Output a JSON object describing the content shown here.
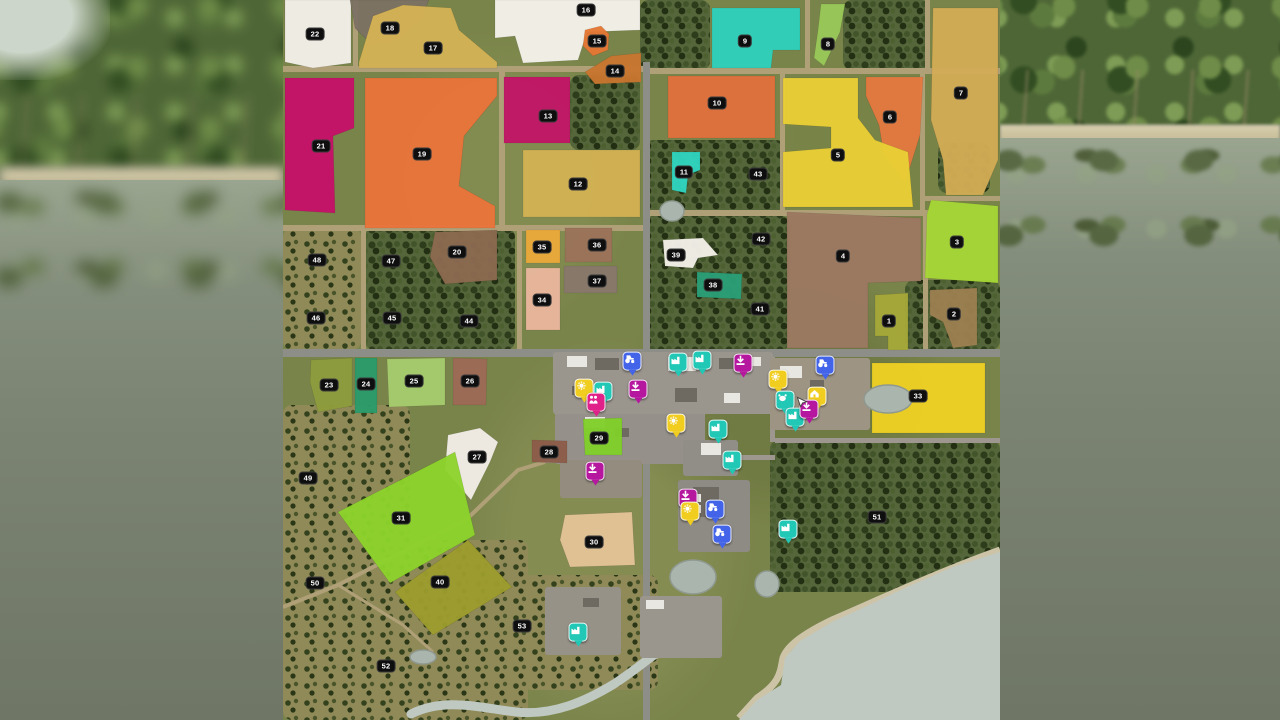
{
  "meta": {
    "view": "farming-map-overview",
    "screen_size": [
      1280,
      720
    ],
    "map_rect": [
      283,
      0,
      717,
      720
    ]
  },
  "palette": {
    "grass": "#79844a",
    "forest_dense": "#55663b",
    "forest_sparse": "#8f8a58",
    "dirt_road": "#b0a078",
    "asphalt_road": "#8e8e88",
    "street": "#9d978f",
    "water": "#bfc9c2",
    "pond": "#aab5ad",
    "sand": "#cdc4a8",
    "label_bg": "#0e0e0e",
    "label_fg": "#ffffff"
  },
  "icon_styles": {
    "sell": {
      "color": "#b5179e",
      "glyph": "download-arrow-icon"
    },
    "production": {
      "color": "#22c8b6",
      "glyph": "factory-icon"
    },
    "store": {
      "color": "#f0cd1f",
      "glyph": "gear-icon"
    },
    "farmhouse": {
      "color": "#f0cd1f",
      "glyph": "house-icon"
    },
    "dealer": {
      "color": "#4364e8",
      "glyph": "tractor-icon"
    },
    "family": {
      "color": "#e0218a",
      "glyph": "people-icon"
    },
    "animal": {
      "color": "#22c8b6",
      "glyph": "cow-icon"
    }
  },
  "fields": [
    {
      "id": "22",
      "color": "#f3efe9",
      "points": "2,0 68,0 68,63 30,68 2,62",
      "label": [
        32,
        34
      ]
    },
    {
      "id": "18",
      "color": "#7c7163",
      "points": "67,0 146,0 138,20 112,42 88,44 72,28",
      "label": [
        107,
        28
      ]
    },
    {
      "id": "17",
      "color": "#d3b254",
      "points": "76,62 90,16 120,5 168,8 176,30 214,62 214,68 76,68",
      "label": [
        150,
        48
      ]
    },
    {
      "id": "16",
      "color": "#f4f1ea",
      "points": "212,0 357,0 357,30 304,32 295,60 240,63 232,36 212,38",
      "label": [
        303,
        10
      ]
    },
    {
      "id": "15",
      "color": "#e47733",
      "points": "302,30 318,26 326,34 325,50 310,56 300,46",
      "label": [
        314,
        41
      ]
    },
    {
      "id": "14",
      "color": "#c8762f",
      "points": "302,72 328,56 358,53 358,82 312,84",
      "label": [
        332,
        71
      ]
    },
    {
      "id": "21",
      "color": "#c61168",
      "points": "2,78 71,78 71,128 50,136 52,213 2,210",
      "label": [
        38,
        146
      ]
    },
    {
      "id": "19",
      "color": "#e9743a",
      "points": "82,78 214,78 214,96 181,136 176,186 212,206 212,228 82,228",
      "label": [
        139,
        154
      ]
    },
    {
      "id": "13",
      "color": "#c21567",
      "points": "221,77 287,77 287,143 221,143",
      "label": [
        265,
        116
      ]
    },
    {
      "id": "12",
      "color": "#d2b152",
      "points": "240,150 357,150 357,217 240,217",
      "label": [
        295,
        184
      ]
    },
    {
      "id": "9",
      "color": "#2fd0ba",
      "points": "429,8 517,8 517,50 490,50 488,68 429,68",
      "label": [
        462,
        41
      ]
    },
    {
      "id": "8",
      "color": "#98c858",
      "points": "538,4 562,4 557,32 541,66 531,58 535,30",
      "label": [
        545,
        44
      ]
    },
    {
      "id": "7",
      "color": "#d2ac55",
      "points": "650,8 715,8 715,160 700,195 663,195 660,160 648,120",
      "label": [
        678,
        93
      ]
    },
    {
      "id": "10",
      "color": "#e0703c",
      "points": "385,76 492,76 492,138 385,138",
      "label": [
        434,
        103
      ]
    },
    {
      "id": "6",
      "color": "#e4793f",
      "points": "583,77 640,77 637,135 622,183 601,155 596,125 583,96",
      "label": [
        607,
        117
      ]
    },
    {
      "id": "5",
      "color": "#e9cf35",
      "points": "500,78 575,78 575,118 592,140 625,152 630,207 500,207 500,152 548,148 548,127 500,124",
      "label": [
        555,
        155
      ]
    },
    {
      "id": "11",
      "color": "#2fd4bf",
      "points": "389,152 417,152 417,170 405,175 403,193 389,190",
      "label": [
        401,
        172
      ]
    },
    {
      "id": "3",
      "color": "#a5d636",
      "points": "648,200 715,206 715,283 642,278 644,214",
      "label": [
        674,
        242
      ]
    },
    {
      "id": "4",
      "color": "#9b7961",
      "points": "504,212 638,218 638,281 585,283 585,348 504,348",
      "label": [
        560,
        256
      ]
    },
    {
      "id": "39",
      "color": "#f2efe8",
      "points": "380,240 420,238 435,255 415,258 410,268 382,266",
      "label": [
        393,
        255
      ]
    },
    {
      "id": "38",
      "color": "#2b9e78",
      "points": "414,272 459,274 458,299 414,297",
      "label": [
        430,
        285
      ]
    },
    {
      "id": "1",
      "color": "#a6a838",
      "points": "592,295 625,293 625,350 605,350 605,336 592,336",
      "label": [
        606,
        321
      ]
    },
    {
      "id": "2",
      "color": "#9c8050",
      "points": "647,290 694,288 694,345 670,348 660,322 647,315",
      "label": [
        671,
        314
      ]
    },
    {
      "id": "20",
      "color": "#8b6a50",
      "points": "152,232 214,230 214,280 162,284 147,257",
      "label": [
        174,
        252
      ]
    },
    {
      "id": "35",
      "color": "#eaa93a",
      "points": "243,230 277,230 277,263 243,263",
      "label": [
        259,
        247
      ]
    },
    {
      "id": "36",
      "color": "#9b7258",
      "points": "282,228 329,228 329,262 282,262",
      "label": [
        314,
        245
      ]
    },
    {
      "id": "34",
      "color": "#e9b69c",
      "points": "243,268 277,268 277,330 243,330",
      "label": [
        259,
        300
      ]
    },
    {
      "id": "37",
      "color": "#87786b",
      "points": "281,266 334,266 334,293 281,293",
      "label": [
        314,
        281
      ]
    },
    {
      "id": "23",
      "color": "#8c9c3c",
      "points": "28,360 69,358 69,406 35,412 27,382",
      "label": [
        46,
        385
      ]
    },
    {
      "id": "24",
      "color": "#2b9b6b",
      "points": "72,358 94,358 94,413 72,413",
      "label": [
        83,
        384
      ]
    },
    {
      "id": "25",
      "color": "#a5cc6d",
      "points": "104,359 162,358 162,405 106,407",
      "label": [
        131,
        381
      ]
    },
    {
      "id": "26",
      "color": "#9c6a55",
      "points": "170,358 204,359 203,405 170,405",
      "label": [
        187,
        381
      ]
    },
    {
      "id": "27",
      "color": "#f1ece6",
      "points": "165,435 197,428 215,442 207,462 188,500 162,470",
      "label": [
        194,
        457
      ]
    },
    {
      "id": "28",
      "color": "#8d5c49",
      "points": "249,440 284,441 284,463 249,462",
      "label": [
        266,
        452
      ]
    },
    {
      "id": "29",
      "color": "#80cf2a",
      "points": "300,419 339,418 339,455 302,455",
      "label": [
        316,
        438
      ]
    },
    {
      "id": "31",
      "color": "#8cd32c",
      "points": "172,452 192,535 107,583 55,512",
      "label": [
        118,
        518
      ]
    },
    {
      "id": "40",
      "color": "#9c9c2e",
      "points": "185,540 229,587 150,635 112,592",
      "label": [
        157,
        582
      ]
    },
    {
      "id": "30",
      "color": "#e3c397",
      "points": "282,515 349,512 352,565 287,567 277,540",
      "label": [
        311,
        542
      ]
    },
    {
      "id": "33",
      "color": "#eed023",
      "points": "589,363 702,363 702,433 589,433",
      "label": [
        635,
        396
      ]
    }
  ],
  "forest_labels": [
    {
      "id": "41",
      "pos": [
        477,
        309
      ]
    },
    {
      "id": "42",
      "pos": [
        478,
        239
      ]
    },
    {
      "id": "43",
      "pos": [
        475,
        174
      ]
    },
    {
      "id": "44",
      "pos": [
        186,
        321
      ]
    },
    {
      "id": "45",
      "pos": [
        109,
        318
      ]
    },
    {
      "id": "46",
      "pos": [
        33,
        318
      ]
    },
    {
      "id": "47",
      "pos": [
        108,
        261
      ]
    },
    {
      "id": "48",
      "pos": [
        34,
        260
      ]
    },
    {
      "id": "49",
      "pos": [
        25,
        478
      ]
    },
    {
      "id": "50",
      "pos": [
        32,
        583
      ]
    },
    {
      "id": "51",
      "pos": [
        594,
        517
      ]
    },
    {
      "id": "52",
      "pos": [
        103,
        666
      ]
    },
    {
      "id": "53",
      "pos": [
        239,
        626
      ]
    }
  ],
  "icons": [
    {
      "type": "dealer",
      "pos": [
        349,
        363
      ]
    },
    {
      "type": "production",
      "pos": [
        395,
        364
      ]
    },
    {
      "type": "production",
      "pos": [
        419,
        362
      ]
    },
    {
      "type": "sell",
      "pos": [
        460,
        365
      ]
    },
    {
      "type": "store",
      "pos": [
        301,
        390
      ]
    },
    {
      "type": "production",
      "pos": [
        320,
        393
      ]
    },
    {
      "type": "family",
      "pos": [
        313,
        404
      ]
    },
    {
      "type": "sell",
      "pos": [
        355,
        391
      ]
    },
    {
      "type": "dealer",
      "pos": [
        542,
        367
      ]
    },
    {
      "type": "store",
      "pos": [
        495,
        381
      ]
    },
    {
      "type": "farmhouse",
      "pos": [
        534,
        398
      ]
    },
    {
      "type": "animal",
      "pos": [
        502,
        402
      ]
    },
    {
      "type": "production",
      "pos": [
        512,
        419
      ]
    },
    {
      "type": "sell",
      "pos": [
        526,
        411
      ]
    },
    {
      "type": "store",
      "pos": [
        393,
        425
      ]
    },
    {
      "type": "production",
      "pos": [
        435,
        431
      ]
    },
    {
      "type": "production",
      "pos": [
        449,
        462
      ]
    },
    {
      "type": "sell",
      "pos": [
        312,
        473
      ]
    },
    {
      "type": "sell",
      "pos": [
        405,
        500
      ]
    },
    {
      "type": "store",
      "pos": [
        407,
        513
      ]
    },
    {
      "type": "dealer",
      "pos": [
        432,
        511
      ]
    },
    {
      "type": "dealer",
      "pos": [
        439,
        536
      ]
    },
    {
      "type": "production",
      "pos": [
        505,
        531
      ]
    },
    {
      "type": "production",
      "pos": [
        295,
        634
      ]
    }
  ],
  "player_marker": {
    "pos": [
      512,
      395
    ]
  },
  "geometry": {
    "roads": [
      {
        "r": [
          0,
          66,
          362,
          6
        ],
        "c": "dirt"
      },
      {
        "r": [
          362,
          68,
          355,
          6
        ],
        "c": "dirt"
      },
      {
        "r": [
          70,
          0,
          5,
          66
        ],
        "c": "dirt"
      },
      {
        "r": [
          216,
          68,
          6,
          160
        ],
        "c": "dirt"
      },
      {
        "r": [
          0,
          225,
          362,
          6
        ],
        "c": "dirt"
      },
      {
        "r": [
          78,
          228,
          5,
          124
        ],
        "c": "dirt"
      },
      {
        "r": [
          234,
          228,
          5,
          124
        ],
        "c": "dirt"
      },
      {
        "r": [
          497,
          72,
          5,
          140
        ],
        "c": "dirt"
      },
      {
        "r": [
          637,
          72,
          5,
          140
        ],
        "c": "dirt"
      },
      {
        "r": [
          362,
          210,
          282,
          6
        ],
        "c": "dirt"
      },
      {
        "r": [
          640,
          196,
          77,
          5
        ],
        "c": "dirt"
      },
      {
        "r": [
          640,
          210,
          5,
          142
        ],
        "c": "dirt"
      },
      {
        "r": [
          522,
          0,
          5,
          68
        ],
        "c": "dirt"
      },
      {
        "r": [
          642,
          0,
          5,
          70
        ],
        "c": "dirt"
      },
      {
        "r": [
          360,
          62,
          7,
          658
        ],
        "c": "asphalt"
      },
      {
        "r": [
          0,
          349,
          717,
          8
        ],
        "c": "asphalt"
      },
      {
        "r": [
          377,
          357,
          5,
          105
        ],
        "c": "street"
      },
      {
        "r": [
          417,
          357,
          5,
          105
        ],
        "c": "street"
      },
      {
        "r": [
          325,
          357,
          5,
          57
        ],
        "c": "street"
      },
      {
        "r": [
          272,
          410,
          150,
          5
        ],
        "c": "street"
      },
      {
        "r": [
          362,
          455,
          130,
          5
        ],
        "c": "street"
      },
      {
        "r": [
          487,
          357,
          5,
          85
        ],
        "c": "street"
      },
      {
        "r": [
          492,
          438,
          225,
          5
        ],
        "c": "street"
      },
      {
        "r": [
          255,
          458,
          110,
          5
        ],
        "c": "street"
      }
    ],
    "road_paths": [
      {
        "d": "M 0,607 L 55,585 185,518 235,470 262,462",
        "c": "dirt",
        "w": 4
      },
      {
        "d": "M 55,585 L 120,625 150,652",
        "c": "dirt",
        "w": 3
      }
    ],
    "forests": [
      {
        "r": [
          357,
          0,
          70,
          70
        ],
        "p": "d"
      },
      {
        "r": [
          560,
          0,
          87,
          70
        ],
        "p": "d"
      },
      {
        "r": [
          287,
          75,
          70,
          75
        ],
        "p": "d"
      },
      {
        "r": [
          362,
          140,
          140,
          72
        ],
        "p": "d"
      },
      {
        "r": [
          362,
          216,
          145,
          134
        ],
        "p": "d"
      },
      {
        "r": [
          622,
          280,
          95,
          70
        ],
        "p": "d"
      },
      {
        "r": [
          0,
          228,
          78,
          122
        ],
        "p": "s"
      },
      {
        "r": [
          82,
          228,
          150,
          122
        ],
        "p": "d"
      },
      {
        "r": [
          655,
          143,
          52,
          50
        ],
        "p": "d"
      },
      {
        "r": [
          0,
          405,
          127,
          150
        ],
        "p": "s"
      },
      {
        "r": [
          0,
          540,
          245,
          180
        ],
        "p": "s"
      },
      {
        "r": [
          240,
          575,
          135,
          115
        ],
        "p": "s"
      },
      {
        "r": [
          487,
          440,
          230,
          152
        ],
        "p": "d"
      }
    ],
    "areas": [
      {
        "r": [
          270,
          352,
          220,
          62
        ],
        "c": "#9a958d"
      },
      {
        "r": [
          272,
          414,
          150,
          50
        ],
        "c": "#95908a"
      },
      {
        "r": [
          277,
          460,
          82,
          38
        ],
        "c": "#948d7f"
      },
      {
        "r": [
          395,
          480,
          72,
          72
        ],
        "c": "#8e8a84"
      },
      {
        "r": [
          400,
          440,
          55,
          36
        ],
        "c": "#918d87"
      },
      {
        "r": [
          487,
          358,
          100,
          72
        ],
        "c": "#9d9483"
      },
      {
        "r": [
          262,
          587,
          76,
          68
        ],
        "c": "#979287"
      },
      {
        "r": [
          357,
          596,
          82,
          62
        ],
        "c": "#9a968e"
      }
    ],
    "buildings": [
      [
        284,
        356,
        20,
        11,
        "w"
      ],
      [
        312,
        358,
        24,
        12,
        "d"
      ],
      [
        345,
        356,
        12,
        9,
        "w"
      ],
      [
        385,
        357,
        28,
        14,
        "w"
      ],
      [
        436,
        358,
        18,
        11,
        "d"
      ],
      [
        464,
        357,
        14,
        9,
        "w"
      ],
      [
        289,
        386,
        16,
        9,
        "d"
      ],
      [
        302,
        417,
        20,
        11,
        "w"
      ],
      [
        332,
        428,
        14,
        9,
        "d"
      ],
      [
        392,
        388,
        22,
        14,
        "d"
      ],
      [
        441,
        393,
        16,
        10,
        "w"
      ],
      [
        497,
        366,
        22,
        12,
        "w"
      ],
      [
        527,
        380,
        14,
        9,
        "d"
      ],
      [
        363,
        600,
        18,
        9,
        "w"
      ],
      [
        300,
        598,
        16,
        9,
        "d"
      ],
      [
        410,
        487,
        26,
        30,
        "d"
      ],
      [
        418,
        443,
        20,
        12,
        "w"
      ],
      [
        398,
        494,
        20,
        8,
        "w"
      ],
      [
        398,
        505,
        20,
        8,
        "w"
      ]
    ],
    "water": {
      "bay": "M717 552 L670 567 622 588 584 606 549 622 517 641 502 658 498 685 474 700 456 720 L717 720 Z",
      "shore": "M717 550 C 660 570 600 598 549 620 C 520 634 504 646 500 658 C 497 672 498 682 474 698 L456 718",
      "river": "M128 714 C 162 697 198 708 233 712 C 270 716 303 701 331 684 C 351 671 362 661 374 653",
      "channel": "M374 655 C 378 638 380 620 392 612",
      "ponds": [
        [
          410,
          577,
          23,
          17
        ],
        [
          484,
          584,
          12,
          13
        ],
        [
          605,
          399,
          24,
          14
        ],
        [
          389,
          211,
          12,
          10
        ],
        [
          140,
          657,
          13,
          7
        ]
      ]
    }
  }
}
